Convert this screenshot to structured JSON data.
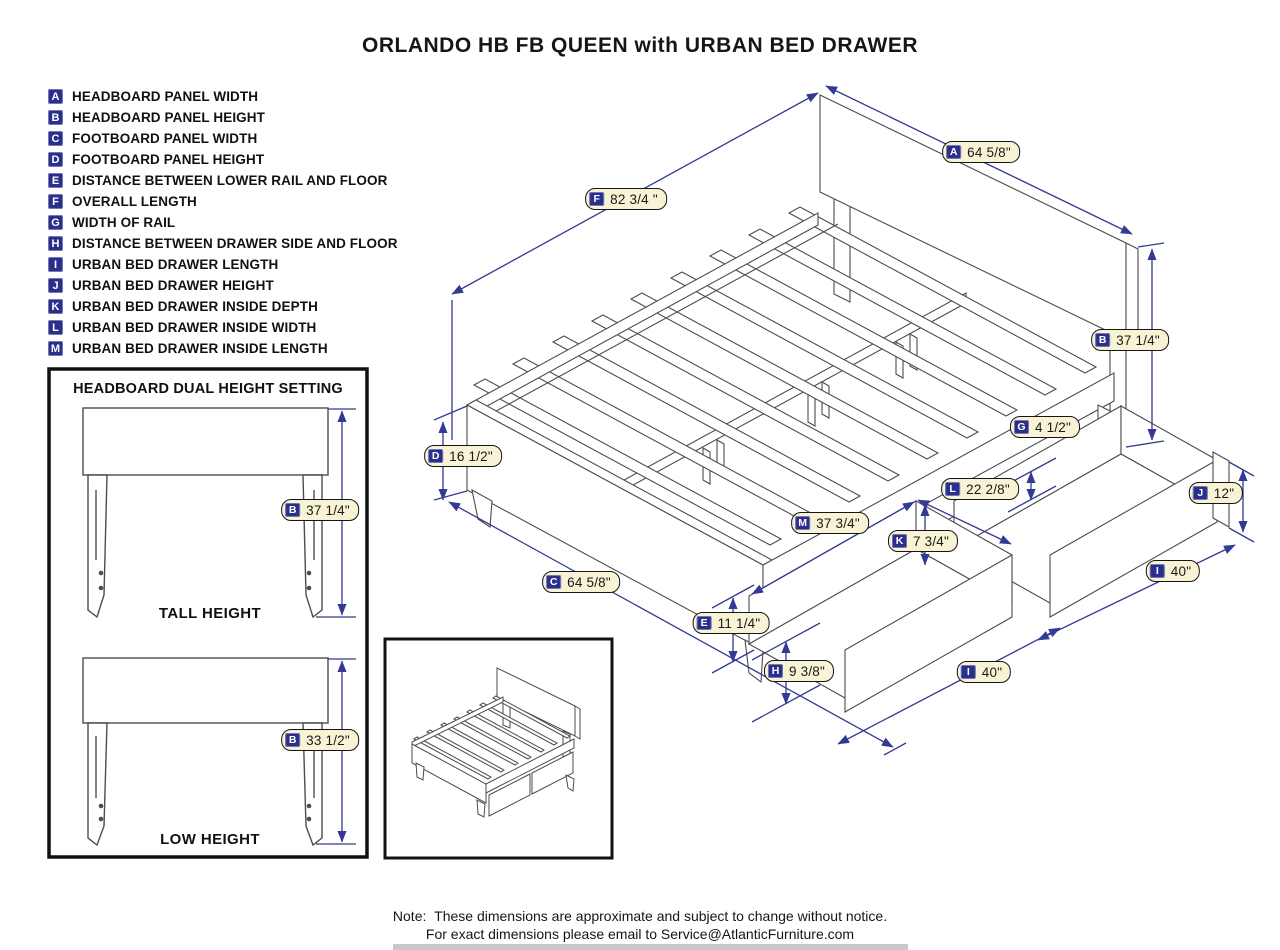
{
  "title": "ORLANDO HB FB QUEEN with URBAN BED DRAWER",
  "legend": {
    "items": [
      {
        "letter": "A",
        "label": "HEADBOARD PANEL WIDTH"
      },
      {
        "letter": "B",
        "label": "HEADBOARD PANEL HEIGHT"
      },
      {
        "letter": "C",
        "label": "FOOTBOARD PANEL WIDTH"
      },
      {
        "letter": "D",
        "label": "FOOTBOARD PANEL HEIGHT"
      },
      {
        "letter": "E",
        "label": "DISTANCE BETWEEN LOWER RAIL AND FLOOR"
      },
      {
        "letter": "F",
        "label": "OVERALL LENGTH"
      },
      {
        "letter": "G",
        "label": "WIDTH OF RAIL"
      },
      {
        "letter": "H",
        "label": "DISTANCE BETWEEN DRAWER SIDE AND FLOOR"
      },
      {
        "letter": "I",
        "label": "URBAN BED DRAWER LENGTH"
      },
      {
        "letter": "J",
        "label": "URBAN BED DRAWER HEIGHT"
      },
      {
        "letter": "K",
        "label": "URBAN BED DRAWER INSIDE DEPTH"
      },
      {
        "letter": "L",
        "label": "URBAN BED DRAWER INSIDE WIDTH"
      },
      {
        "letter": "M",
        "label": "URBAN BED DRAWER INSIDE LENGTH"
      }
    ]
  },
  "callouts": [
    {
      "id": "F",
      "letter": "F",
      "value": "82 3/4 \"",
      "x": 626,
      "y": 199
    },
    {
      "id": "A",
      "letter": "A",
      "value": "64 5/8\"",
      "x": 981,
      "y": 152
    },
    {
      "id": "B-main",
      "letter": "B",
      "value": "37 1/4\"",
      "x": 1130,
      "y": 340
    },
    {
      "id": "G",
      "letter": "G",
      "value": "4 1/2\"",
      "x": 1045,
      "y": 427
    },
    {
      "id": "L",
      "letter": "L",
      "value": "22 2/8\"",
      "x": 980,
      "y": 489
    },
    {
      "id": "J",
      "letter": "J",
      "value": "12\"",
      "x": 1216,
      "y": 493
    },
    {
      "id": "M",
      "letter": "M",
      "value": "37 3/4\"",
      "x": 830,
      "y": 523
    },
    {
      "id": "K",
      "letter": "K",
      "value": "7 3/4\"",
      "x": 923,
      "y": 541
    },
    {
      "id": "I-right",
      "letter": "I",
      "value": "40\"",
      "x": 1173,
      "y": 571
    },
    {
      "id": "C",
      "letter": "C",
      "value": "64 5/8\"",
      "x": 581,
      "y": 582
    },
    {
      "id": "D",
      "letter": "D",
      "value": "16 1/2\"",
      "x": 463,
      "y": 456
    },
    {
      "id": "E",
      "letter": "E",
      "value": "11 1/4\"",
      "x": 731,
      "y": 623
    },
    {
      "id": "H",
      "letter": "H",
      "value": "9 3/8\"",
      "x": 799,
      "y": 671
    },
    {
      "id": "I-bottom",
      "letter": "I",
      "value": "40\"",
      "x": 984,
      "y": 672
    },
    {
      "id": "B-tall",
      "letter": "B",
      "value": "37 1/4\"",
      "x": 320,
      "y": 510
    },
    {
      "id": "B-low",
      "letter": "B",
      "value": "33 1/2\"",
      "x": 320,
      "y": 740
    }
  ],
  "headboard_box": {
    "title": "HEADBOARD DUAL HEIGHT SETTING",
    "tall_label": "TALL HEIGHT",
    "low_label": "LOW HEIGHT"
  },
  "note": {
    "label": "Note:",
    "line1": "These dimensions are approximate and subject to change without notice.",
    "line2": "For exact dimensions please email to Service@AtlanticFurniture.com"
  },
  "colors": {
    "badge_navy": "#2A2F8C",
    "pill_bg": "#F7F3D4",
    "dimension_blue": "#333A93",
    "drawing_gray": "#4d4d4d"
  }
}
